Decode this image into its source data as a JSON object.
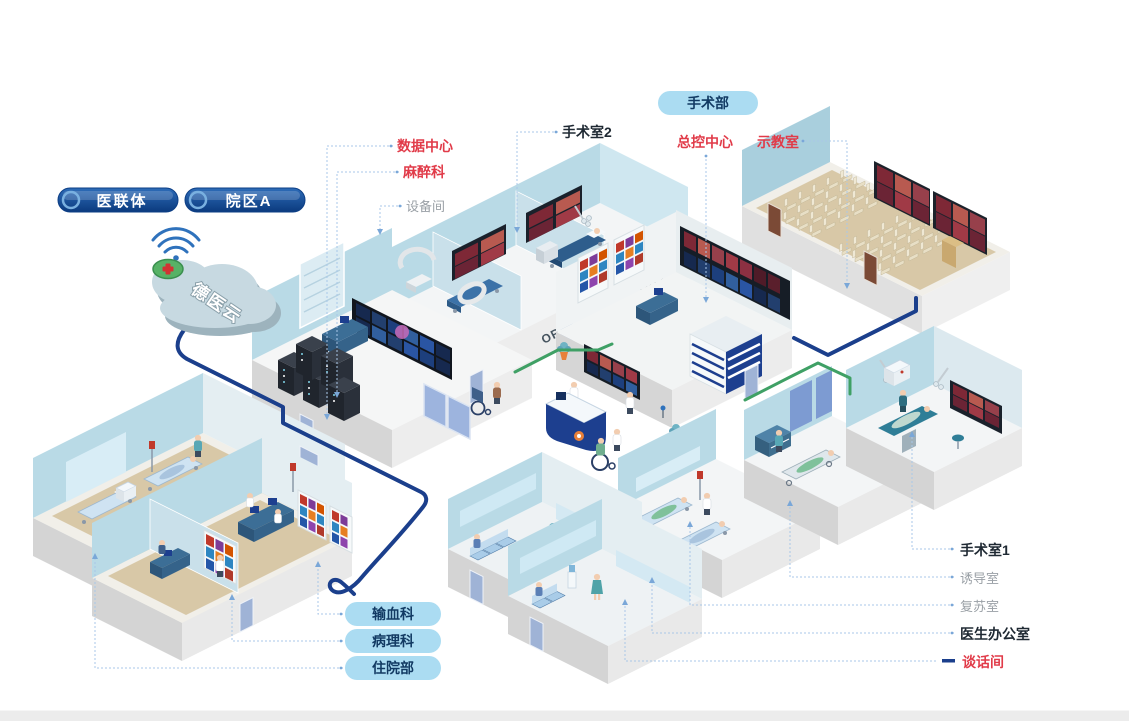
{
  "badges": {
    "alliance": "医联体",
    "campus": "院区A",
    "surgery_dept": "手术部"
  },
  "cloud": {
    "label": "德医云"
  },
  "wall_texts": {
    "or3": "OR3",
    "or2": "OR2"
  },
  "labels": {
    "data_center": "数据中心",
    "anesthesia": "麻醉科",
    "equipment_room": "设备间",
    "operating_room_2": "手术室2",
    "master_control": "总控中心",
    "demo_classroom": "示教室",
    "blood_transfusion": "输血科",
    "pathology": "病理科",
    "inpatient": "住院部",
    "operating_room_1": "手术室1",
    "induction_room": "诱导室",
    "recovery_room": "复苏室",
    "doctor_office": "医生办公室",
    "talk_room": "谈话间"
  },
  "icons": {
    "wifi": "wifi-icon",
    "cloud": "cloud-platform-icon",
    "cross_button": "medical-cross-icon"
  },
  "colors": {
    "label_red": "#e13b49",
    "label_dark": "#1f2933",
    "label_gray": "#9aa0a6",
    "pill_navy_top": "#2e6cb8",
    "pill_navy_bottom": "#0b3a7e",
    "pill_light_bg": "#abdcf2",
    "pill_text": "#123a63",
    "leader_line": "#a9c7e8",
    "cable_navy": "#1b3f8c",
    "cable_green": "#3fa065",
    "wall_blue": "#b9dae6",
    "floor_tan": "#d8c8a7",
    "screen_dark": "#1a212b",
    "footer_bar": "#ececec"
  }
}
